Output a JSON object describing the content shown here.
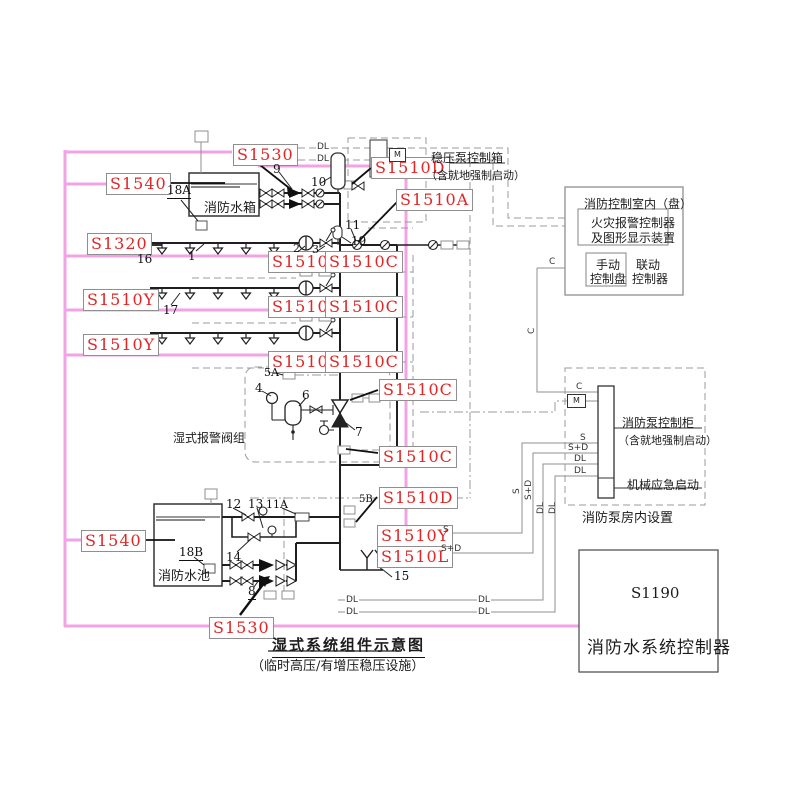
{
  "colors": {
    "bus_pink": "#f2a3e4",
    "tag_red": "#e02626",
    "pipe_dark": "#1f1f1f",
    "wire_gray": "#8f8f8f"
  },
  "tags": {
    "s1190": "S1190",
    "s1320": "S1320",
    "s1530": "S1530",
    "s1540": "S1540",
    "s1510a": "S1510A",
    "s1510b": "S1510B",
    "s1510c": "S1510C",
    "s1510d": "S1510D",
    "s1510l": "S1510L",
    "s1510y": "S1510Y"
  },
  "texts": {
    "tank_upper": "消防水箱",
    "tank_lower": "消防水池",
    "alarm_group": "湿式报警阀组",
    "controller_name": "消防水系统控制器",
    "title_main": "湿式系统组件示意图",
    "title_sub": "（临时高压/有增压稳压设施）"
  },
  "boxes": {
    "stab_pump": {
      "line1": "稳压泵控制箱",
      "line2": "（含就地强制启动）"
    },
    "control_room": {
      "title": "消防控制室内（盘）",
      "alarm_line1": "火灾报警控制器",
      "alarm_line2": "及图形显示装置",
      "manual_line1": "手动",
      "manual_line2": "控制盘",
      "linkage_line1": "联动",
      "linkage_line2": "控制器"
    },
    "pump_room": {
      "cabinet_line1": "消防泵控制柜",
      "cabinet_line2": "（含就地强制启动）",
      "mechanical": "机械应急启动",
      "caption": "消防泵房内设置"
    }
  },
  "part_numbers": {
    "n1": "1",
    "n2": "2",
    "n3": "3",
    "n4": "4",
    "n5a": "5A",
    "n5b": "5B",
    "n6": "6",
    "n7": "7",
    "n8": "8",
    "n9": "9",
    "n10": "10",
    "n11": "11",
    "n11a": "11A",
    "n12": "12",
    "n13": "13",
    "n14": "14",
    "n15": "15",
    "n16": "16",
    "n17": "17",
    "n18a": "18A",
    "n18b": "18B",
    "n19": "19"
  },
  "wire_labels": {
    "c": "C",
    "m": "M",
    "s": "S",
    "sd": "S+D",
    "dl": "DL"
  }
}
